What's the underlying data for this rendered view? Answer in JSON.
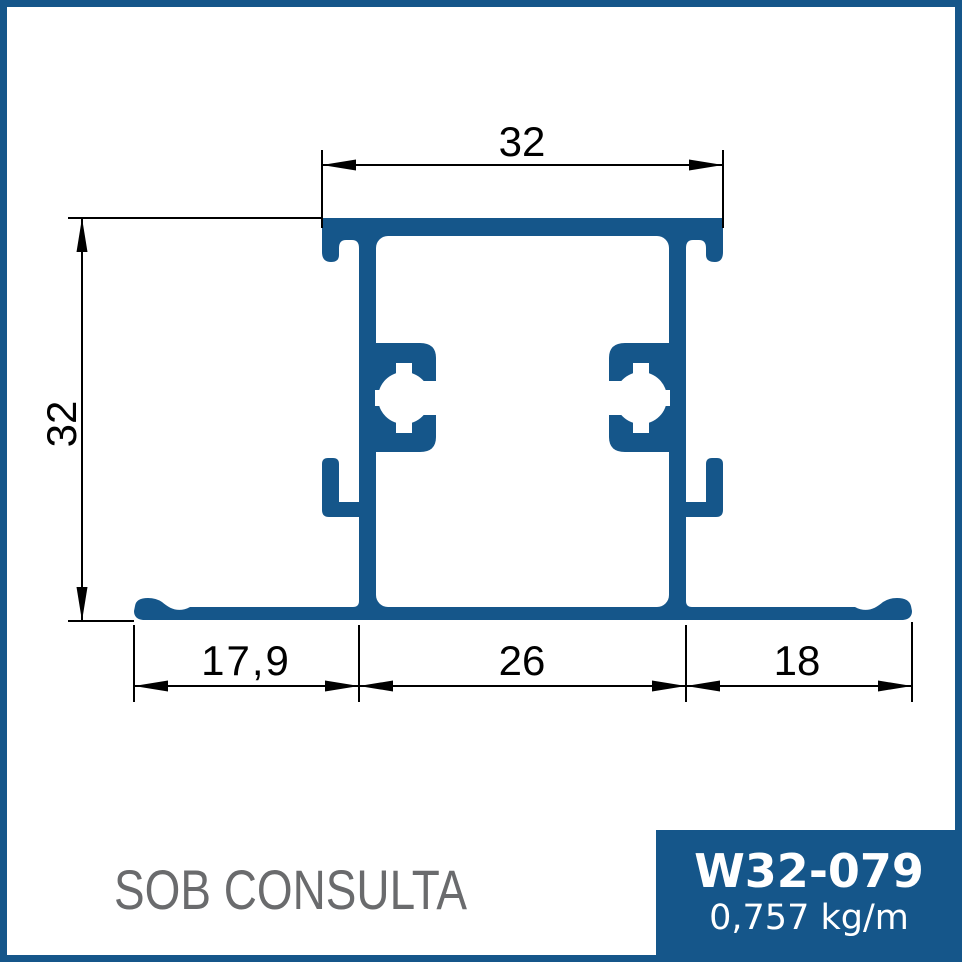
{
  "colors": {
    "accent_blue": "#15568A",
    "dimension_black": "#000000",
    "status_gray": "#6A6B6D",
    "background": "#FFFFFF"
  },
  "drawing": {
    "dim_top_width": "32",
    "dim_left_height": "32",
    "dim_bottom_left": "17,9",
    "dim_bottom_center": "26",
    "dim_bottom_right": "18"
  },
  "footer": {
    "status": "SOB CONSULTA",
    "part_code": "W32-079",
    "weight": "0,757 kg/m"
  }
}
